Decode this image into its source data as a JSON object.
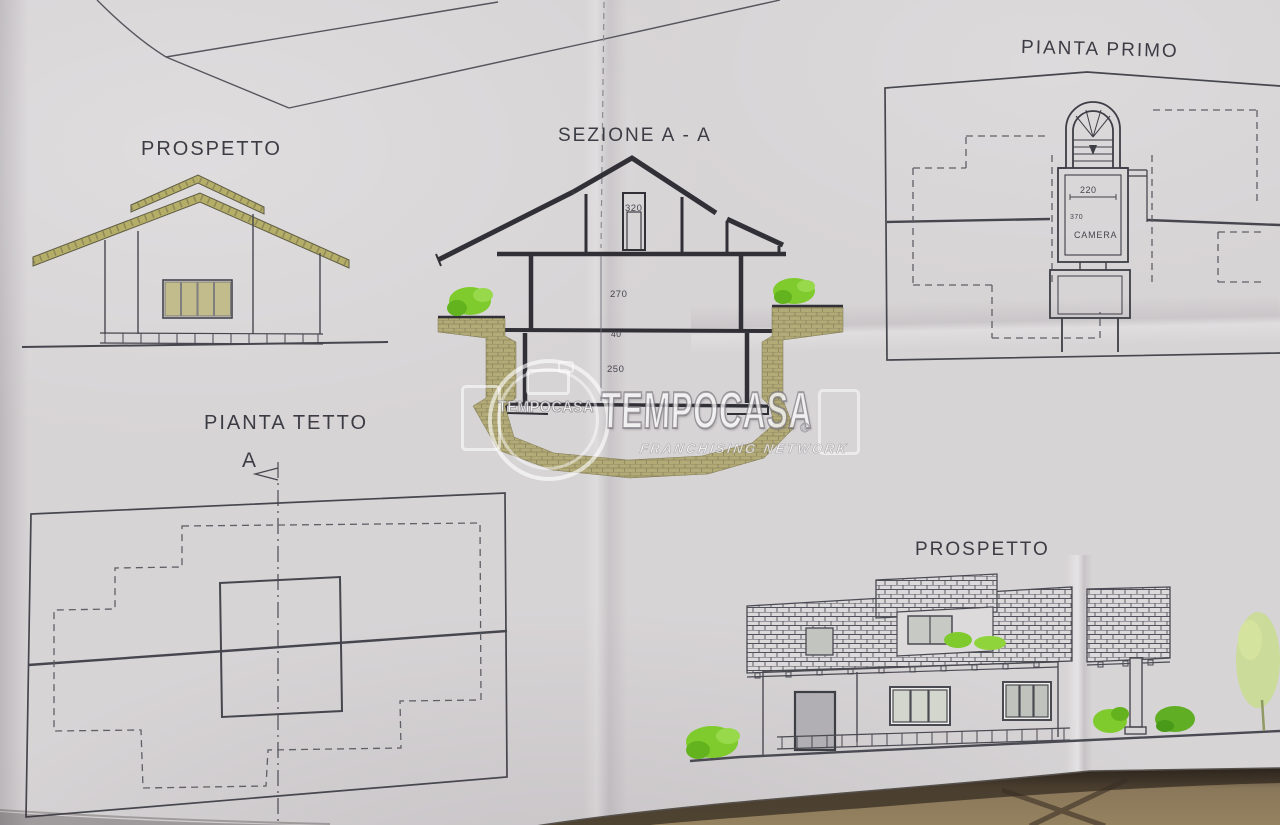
{
  "drawing": {
    "labels": {
      "front_elevation": "PROSPETTO",
      "section": "SEZIONE A - A",
      "first_floor_plan": "PIANTA PRIMO",
      "roof_plan": "PIANTA TETTO",
      "side_elevation": "PROSPETTO",
      "section_marker": "A"
    },
    "dimensions": {
      "attic_height": "320",
      "first_floor_height": "270",
      "slab_thickness": "40",
      "ground_floor_height": "250",
      "stair_width": "220",
      "room_depth": "370"
    },
    "rooms": {
      "bedroom": "CAMERA"
    }
  },
  "watermark": {
    "brand": "TEMPOCASA",
    "registered": "®",
    "brand_small": "TEMPOCASA",
    "subtitle": "FRANCHISING NETWORK"
  },
  "colors": {
    "paper": "#d7d4d6",
    "line": "#46464e",
    "olive": "#b5ae68",
    "earth": "#b2aa77",
    "tile": "#dbd9da",
    "green": "#7fcb2d",
    "floor": "#8a775a"
  }
}
